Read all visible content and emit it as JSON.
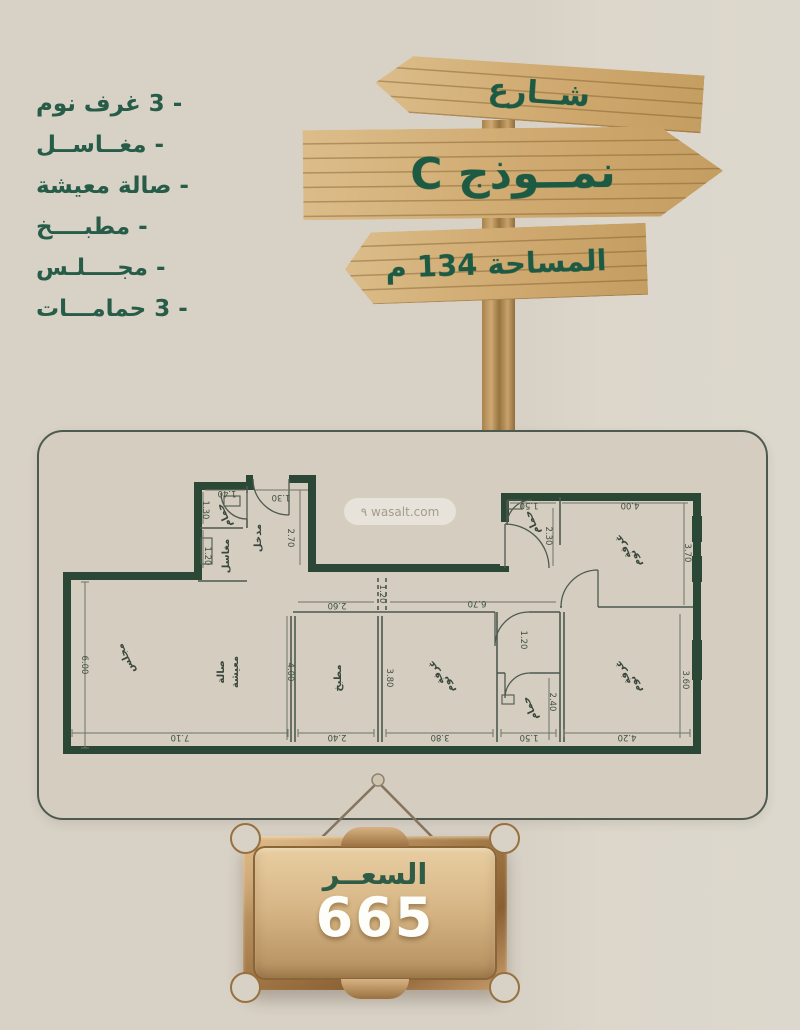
{
  "features": {
    "items": [
      "- 3 غرف نوم",
      "- مغــاســل",
      "- صالة معيشة",
      "- مطبــــخ",
      "- مجــــلـس",
      "- 3 حمامـــات"
    ]
  },
  "sign": {
    "street": "شــارع",
    "model": "نمــوذج C",
    "area": "المساحة 134 م"
  },
  "watermark": "wasalt.com ٩",
  "price": {
    "label": "السعــر",
    "value": "665"
  },
  "plan": {
    "rooms": [
      {
        "l1": "مجلس"
      },
      {
        "l1": "صالة",
        "l2": "معيشة"
      },
      {
        "l1": "مطبخ"
      },
      {
        "l1": "غرفة",
        "l2": "نوم"
      },
      {
        "l1": "حمام"
      },
      {
        "l1": "غرفة",
        "l2": "نوم"
      },
      {
        "l1": "غرفة",
        "l2": "نوم"
      },
      {
        "l1": "حمام"
      },
      {
        "l1": "حمام"
      },
      {
        "l1": "مدخل"
      },
      {
        "l1": "مغاسل"
      }
    ],
    "dims": [
      "7.10",
      "2.40",
      "3.80",
      "1.50",
      "4.20",
      "6.00",
      "4.00",
      "3.80",
      "1.20",
      "2.40",
      "3.60",
      "3.70",
      "2.30",
      "2.60",
      "6.70",
      "1.20",
      "1.40",
      "1.30",
      "1.50",
      "4.00",
      "1.30",
      "1.20",
      "2.70"
    ]
  },
  "colors": {
    "background": "#d8d1c6",
    "card": "#d4cdc0",
    "wall_green": "#2b4836",
    "text_green": "#265c48",
    "sign_green": "#1d5a44",
    "wood": "#cfa96f",
    "gold": "#b1885a",
    "price_text": "#fdfdfa"
  }
}
